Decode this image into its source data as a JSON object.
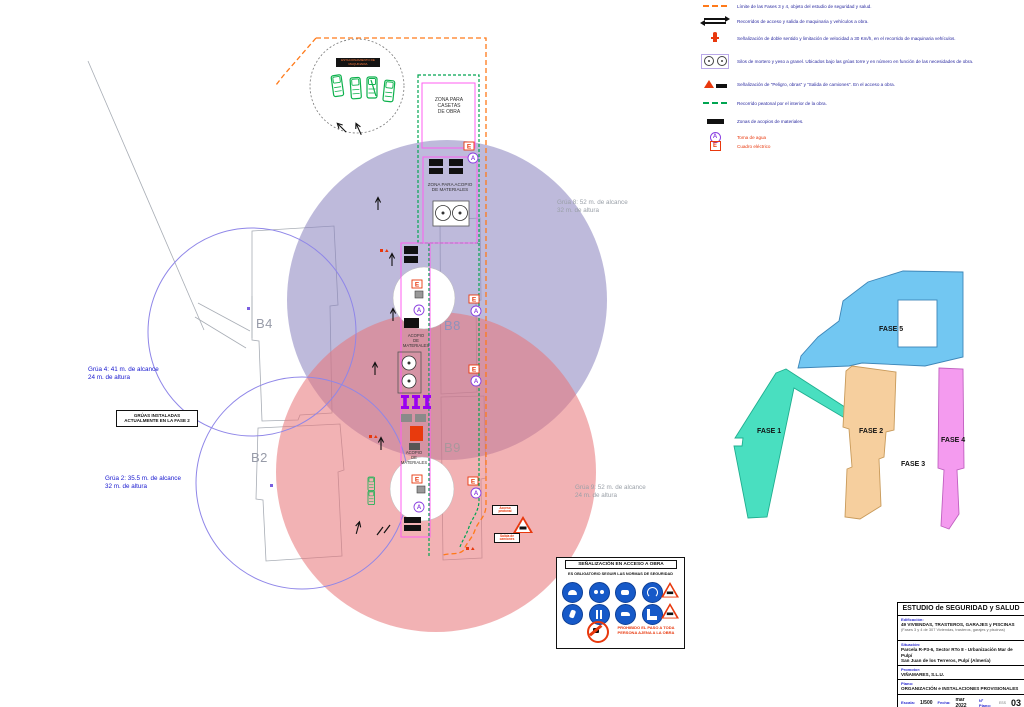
{
  "colors": {
    "phase_limit_orange": "#ff7a1a",
    "pedestrian_green": "#00a551",
    "zone_magenta": "#ff5ef0",
    "crane8_circle_lavender": "#8981be",
    "crane9_circle_pink": "#e87377",
    "crane_outline_blue": "#8f86e8",
    "crane_text_blue": "#1717cf",
    "grey_text": "#9aa0a8",
    "legend_text_navy": "#2a2aa0",
    "red_marker": "#e8380d",
    "water_point_purple": "#8a3fe0",
    "formwork_purple": "#9a00f2",
    "machinery_green": "#0cb14c",
    "fase1_teal": "#49dfc0",
    "fase2_tan": "#f6cf9e",
    "fase4_pink": "#f49bef",
    "fase5_blue": "#72c7f2",
    "mandatory_sign_blue": "#1659c8"
  },
  "legend": {
    "items": [
      {
        "icon": "orange-dashed-line",
        "text": "Límite de las Fases 3 y 4, objeto del estudio de seguridad y salud."
      },
      {
        "icon": "access-arrows",
        "text": "Recorridos de acceso y salida de maquinaria y vehículos a obra."
      },
      {
        "icon": "two-way-speed-sign",
        "text": "Señalización de doble sentido y limitación de velocidad a 30 Km/h, en el recorrido de maquinaria vehículos."
      },
      {
        "icon": "silos",
        "text": "Silos de mortero y yeso a granel. Ubicados bajo las grúas torre y en número en función de las necesidades de obra."
      },
      {
        "icon": "danger-signs",
        "text": "Señalización de \"Peligro, obras\" y \"Salida de camiones\". En el acceso a obra."
      },
      {
        "icon": "green-dashed-line",
        "text": "Recorrido peatonal por el interior de la obra."
      },
      {
        "icon": "black-rect",
        "text": "Zonas de acopios de materiales."
      },
      {
        "icon": "water-point",
        "text": "Toma de agua"
      },
      {
        "icon": "electric-panel",
        "text": "Cuadro eléctrico"
      }
    ]
  },
  "plan": {
    "marker_e": "E",
    "marker_a": "A",
    "zona_casetas": "ZONA PARA\nCASETAS\nDE OBRA",
    "zona_acopio": "ZONA PARA ACOPIO\nDE MATERIALES",
    "acopio_materiales": "ACOPIO\nDE\nMATERIALES",
    "b4": "B4",
    "b8": "B8",
    "b2": "B2",
    "b9": "B9",
    "grua4": "Grúa 4: 41 m. de alcance\n24 m. de altura",
    "grua2": "Grúa 2: 35.5 m. de alcance\n32 m. de altura",
    "grua8": "Grúa 8: 52 m. de alcance\n32 m. de altura",
    "grua9": "Grúa 9: 52 m. de alcance\n24 m. de altura",
    "gruas_instaladas": "GRÚAS INSTALADAS\nACTUALMENTE EN LA FASE 2",
    "maquinaria": "ESTACIONAMIENTO DE\nMAQUINARIA",
    "acceso_peatonal": "Acceso\npeatonal",
    "salida_camiones": "Salida de\ncamiones"
  },
  "phases": {
    "fase1": "FASE 1",
    "fase2": "FASE 2",
    "fase3": "FASE 3",
    "fase4": "FASE 4",
    "fase5": "FASE 5"
  },
  "signage": {
    "title": "SEÑALIZACIÓN EN ACCESO A OBRA",
    "subtitle": "ES OBLIGATORIO SEGUIR LAS NORMAS DE SEGURIDAD",
    "prohibition": "PROHIBIDO EL PASO A TODA\nPERSONA AJENA A LA OBRA"
  },
  "title_block": {
    "title": "ESTUDIO de SEGURIDAD y SALUD",
    "edificacion_label": "Edificación:",
    "edificacion_1": "49 VIVIENDAS, TRASTEROS, GARAJES y PISCINAS",
    "edificacion_2": "(Fases 3 y 4 de 307 Viviendas, trasteros, garajes y piscinas)",
    "situacion_label": "Situación:",
    "situacion_1": "Parcela R-P3-6, Sector RTo 8 - Urbanización Mar de Pulpí",
    "situacion_2": "San Juan de los Terreros, Pulpí (Almería)",
    "promotor_label": "Promotor:",
    "promotor": "VIÑAMARES, S.L.U.",
    "plano_label": "Plano:",
    "plano": "ORGANIZACIÓN e INSTALACIONES PROVISIONALES",
    "escala_label": "Escala:",
    "escala": "1/500",
    "fecha_label": "Fecha:",
    "fecha": "mar 2022",
    "num_label": "Nº Plano:",
    "num_prefix": "ESS",
    "num": "03"
  }
}
